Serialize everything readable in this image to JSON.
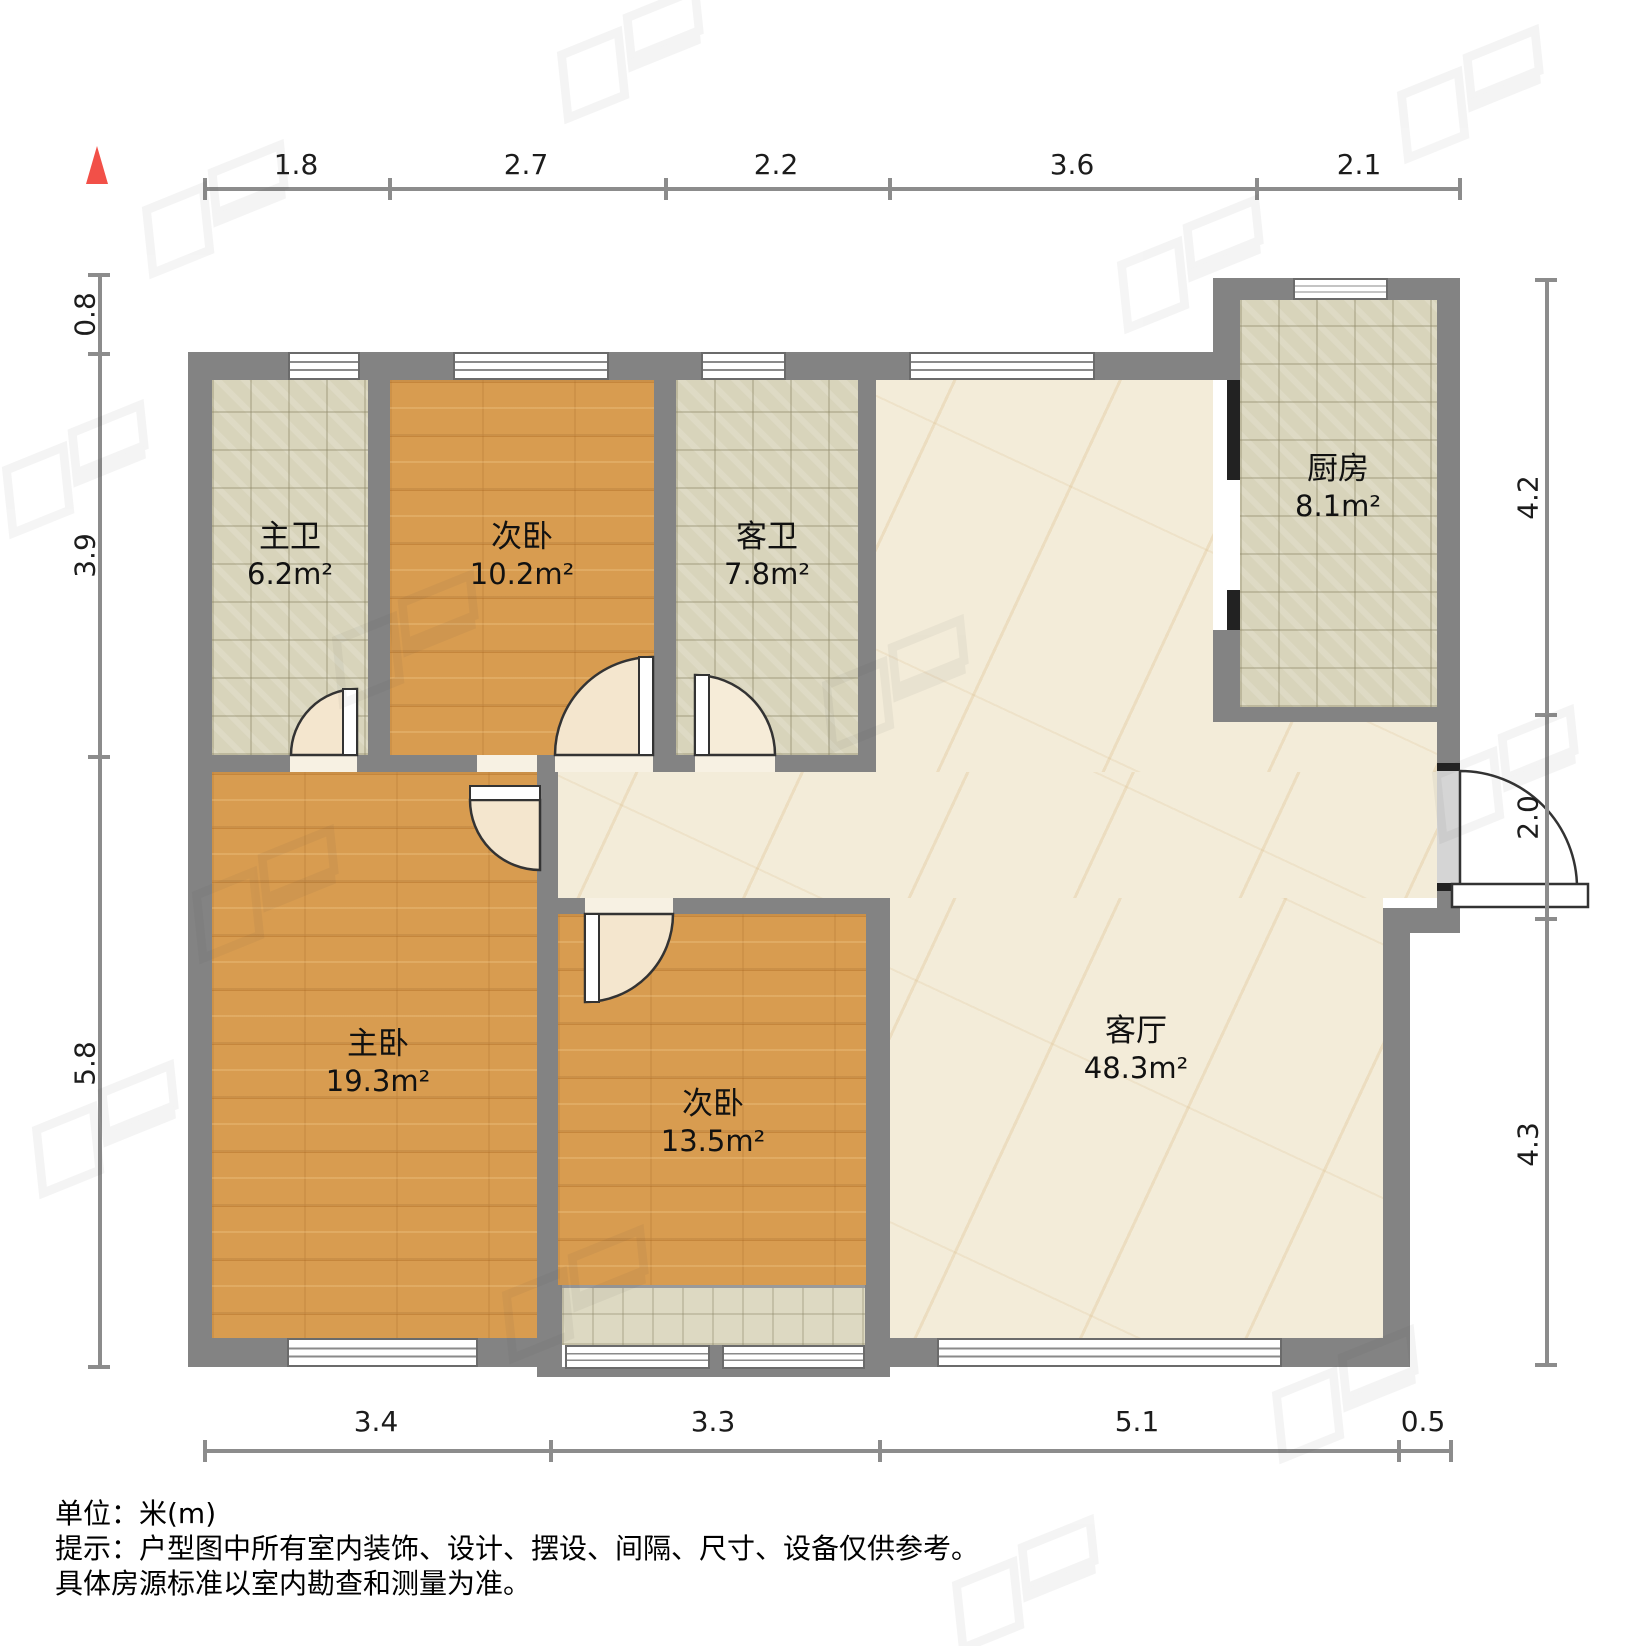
{
  "plan": {
    "type": "floor-plan",
    "rooms": [
      {
        "name": "主卫",
        "area": "6.2m²"
      },
      {
        "name": "次卧",
        "area": "10.2m²"
      },
      {
        "name": "客卫",
        "area": "7.8m²"
      },
      {
        "name": "厨房",
        "area": "8.1m²"
      },
      {
        "name": "主卧",
        "area": "19.3m²"
      },
      {
        "name": "次卧",
        "area": "13.5m²"
      },
      {
        "name": "客厅",
        "area": "48.3m²"
      }
    ],
    "dimensions": {
      "top": [
        "1.8",
        "2.7",
        "2.2",
        "3.6",
        "2.1"
      ],
      "bottom": [
        "3.4",
        "3.3",
        "5.1",
        "0.5"
      ],
      "left": [
        "0.8",
        "3.9",
        "5.8"
      ],
      "right": [
        "4.2",
        "2.0",
        "4.3"
      ]
    }
  },
  "footer": {
    "unit": "单位：米(m)",
    "tip": "提示：户型图中所有室内装饰、设计、摆设、间隔、尺寸、设备仅供参考。",
    "tip2": "具体房源标准以室内勘查和测量为准。"
  },
  "colors": {
    "wall": "#838383",
    "wood_floor": "#d89c50",
    "tile_floor": "#d8d4bb",
    "marble_floor": "#f3ecd9",
    "north_arrow": "#f25048"
  }
}
